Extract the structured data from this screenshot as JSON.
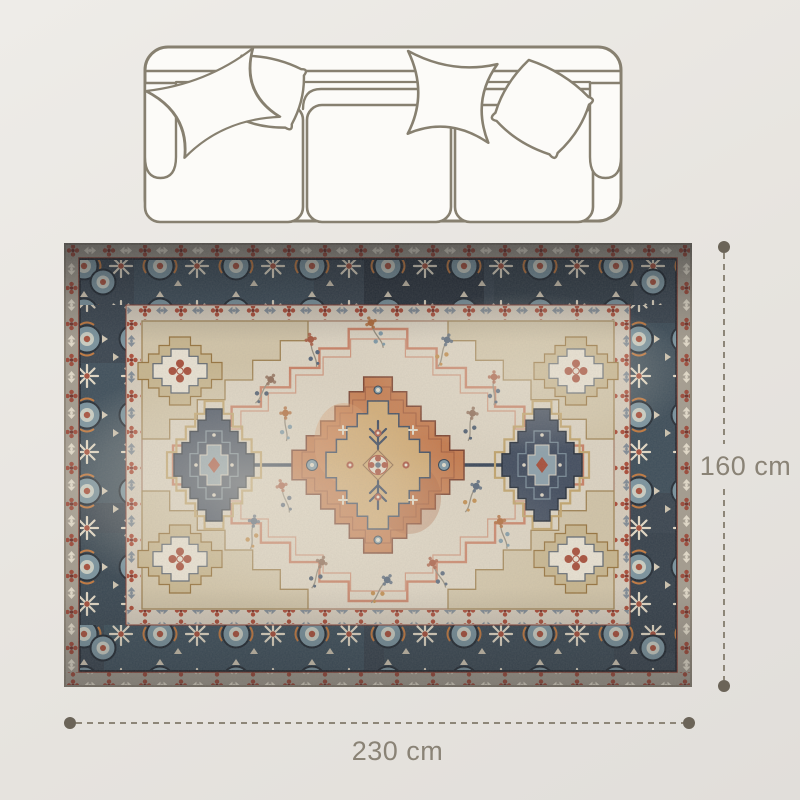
{
  "dimensions": {
    "height_label": "160 cm",
    "width_label": "230 cm"
  },
  "illustrations": {
    "sofa": {
      "name": "sofa-top-view-outline",
      "seat_count": 3,
      "pillow_count": 4
    },
    "rug": {
      "name": "persian-medallion-area-rug"
    }
  },
  "colors": {
    "background": "#e8e5e0",
    "sketch_line": "#878070",
    "dimension_line": "#8d8678",
    "dimension_dot": "#6b6458",
    "label_text": "#8a8376",
    "rug": {
      "edge": "#8f8678",
      "outer_band": "#a59d90",
      "main_border_navy": "#3a4550",
      "border_teal": "#527280",
      "guard_cream": "#d7cdbd",
      "field_cream": "#ddd4c3",
      "accent_red": "#a8503c",
      "accent_salmon": "#c98166",
      "medallion_orange": "#c67c4f",
      "medallion_gold": "#d2ab74",
      "medallion_navy": "#434e60",
      "accent_blue": "#7c95a0",
      "motif_cream": "#e6dcc8",
      "spandrel_tan": "#c8b68f"
    }
  }
}
